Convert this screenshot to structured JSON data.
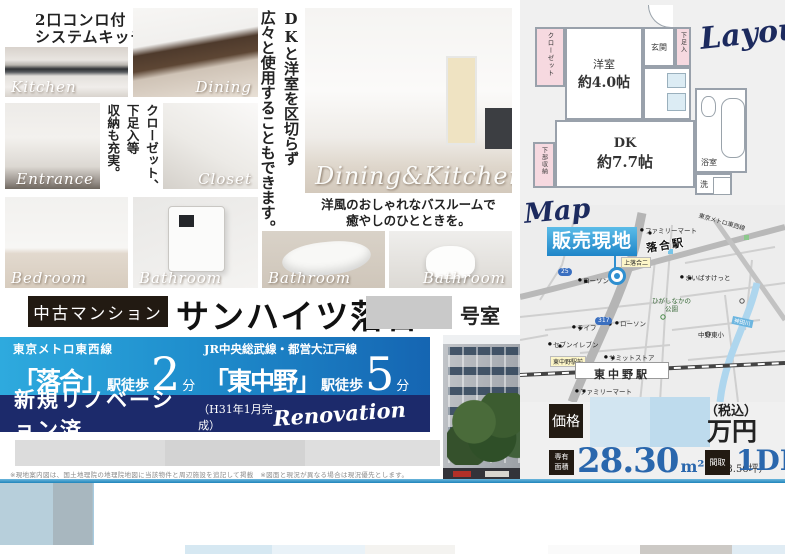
{
  "colors": {
    "band_blue_start": "#2eaade",
    "band_blue_end": "#1565b2",
    "navy_band": "#1c2a6b",
    "price_blue": "#2a67ad",
    "tag_box_black": "#221a12",
    "site_label_blue": "#2f8fd0",
    "heading_navy": "#1c2a5e"
  },
  "header_note": {
    "line1": "2口コンロ付",
    "line2": "システムキッチン"
  },
  "photos": {
    "kitchen": "Kitchen",
    "dining": "Dining",
    "entrance": "Entrance",
    "closet": "Closet",
    "bedroom": "Bedroom",
    "bathroom_panel": "Bathroom",
    "bathroom_tub": "Bathroom",
    "bathroom_toilet": "Bathroom",
    "dining_kitchen": "Dining&Kitchen"
  },
  "captions": {
    "storage": "クローゼット、\n下足入等\n収納も充実。",
    "dk_usage": "DKと洋室を区切らず\n広々と使用することもできます。",
    "bathroom": "洋風のおしゃれなバスルームで\n癒やしのひとときを。"
  },
  "property": {
    "category": "中古マンション",
    "name": "サンハイツ落合",
    "room_suffix": "号室"
  },
  "access": {
    "station1": {
      "line": "東京メトロ東西線",
      "station": "「落合」",
      "walk": "駅徒歩",
      "minutes": "2",
      "unit": "分"
    },
    "station2": {
      "line": "JR中央総武線・都営大江戸線",
      "station": "「東中野」",
      "walk": "駅徒歩",
      "minutes": "5",
      "unit": "分"
    }
  },
  "renovation": {
    "title": "新規リノベーション済",
    "note": "（H31年1月完成）",
    "script": "Renovation"
  },
  "floorplan": {
    "heading": "Layout",
    "rooms": {
      "closet": "クローゼット",
      "western_room": "洋室",
      "western_room_size": "約4.0帖",
      "entrance": "玄関",
      "shoe_box": "下足入",
      "dk": "DK",
      "dk_size": "約7.7帖",
      "under_storage": "下部収納",
      "bath": "浴室",
      "laundry": "洗"
    }
  },
  "map": {
    "heading": "Map",
    "site_label": "販売現地",
    "labels": {
      "ochiai_station": "落合駅",
      "higashinakano_station": "東中野駅",
      "tozai_line": "東京メトロ東西線",
      "kamiochiai": "上落合二",
      "lawson1": "ローソン",
      "lawson2": "ローソン",
      "seven_eleven": "セブンイレブン",
      "summit_store": "サミットストア",
      "family_mart1": "ファミリーマート",
      "family_mart2": "ファミリーマート",
      "life": "ライフ",
      "my_basket": "まいばすけっと",
      "ekimae": "東中野駅前",
      "school": "中野東小",
      "park": "ひがしなかの\n公園",
      "river": "神田川",
      "route1": "25",
      "route2": "317"
    }
  },
  "price": {
    "label": "価格",
    "tax_note": "（税込）",
    "unit": "万円",
    "area_label": "専有\n面積",
    "area_value": "28.30",
    "area_unit": "m²",
    "area_tsubo": "（約8.56坪）",
    "madori_label": "間取",
    "madori_value": "1DK"
  },
  "disclaimer": "※現地案内図は、国土地理院の地理院地図に当該物件と周辺施設を追記して掲載　※図面と現況が異なる場合は現況優先とします。"
}
